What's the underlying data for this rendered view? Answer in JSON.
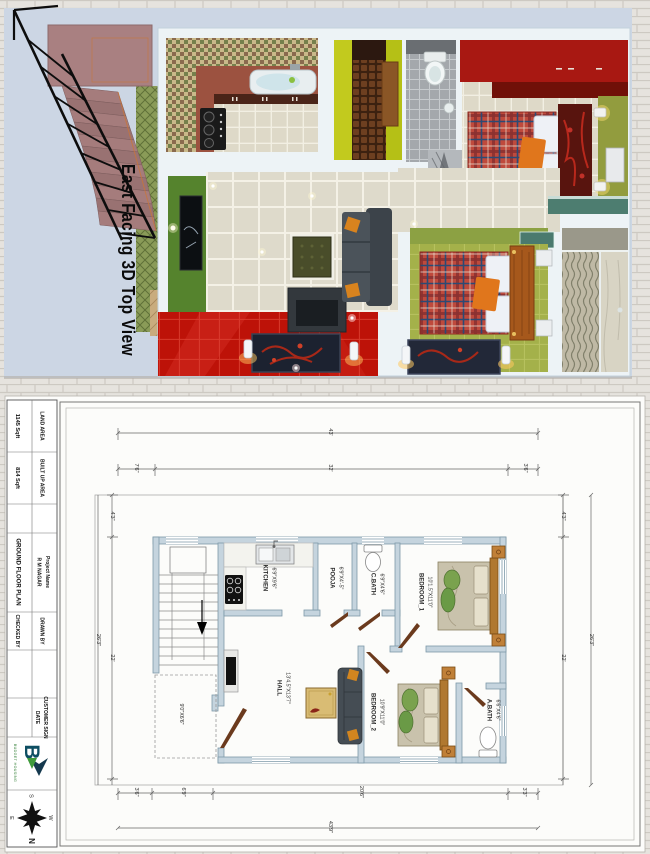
{
  "view3d": {
    "caption": "East Facing 3D Top View"
  },
  "title_block": {
    "land_area_label": "LAND AREA",
    "land_area_value": "1145 Sqft",
    "built_up_label": "BUILT UP AREA",
    "built_up_value": "814 Sqft",
    "project_label": "Project Name",
    "project_name": "R M NAGAR",
    "drawing_title": "GROUND FLOOR PLAN",
    "drawn_by_label": "DRAWN BY",
    "checked_by_label": "CHECKED BY",
    "customer_sign_label": "CUSTOMER SIGN",
    "date_label": "DATE",
    "logo_letter": "B",
    "logo_name": "BUDGET HOUSING",
    "compass": {
      "n": "N",
      "s": "S",
      "e": "E",
      "w": "W"
    }
  },
  "plan": {
    "rooms": {
      "kitchen": {
        "name": "KITCHEN",
        "size": "6'9\"X9'6\""
      },
      "pooja": {
        "name": "POOJA",
        "size": "6'9\"X4'-5\""
      },
      "cbath": {
        "name": "C.BATH",
        "size": "6'9\"X4'6\""
      },
      "bedroom1": {
        "name": "BEDROOM_1",
        "size": "10'1.5\"X11'0\""
      },
      "hall": {
        "name": "HALL",
        "size": "13'4.5\"X13'7\""
      },
      "bedroom2": {
        "name": "BEDROOM_2",
        "size": "10'9\"X11'0\""
      },
      "abath": {
        "name": "A.BATH",
        "size": "6'6\"X4'6\""
      },
      "sitout": {
        "size": "9'0\"X6'6\""
      }
    },
    "dims": {
      "top_total": "43'",
      "top_a": "7'6\"",
      "top_b": "32'",
      "top_c": "3'6\"",
      "left_a": "4'3\"",
      "left_b": "22'",
      "left_total": "26'3\"",
      "right_a": "4'3\"",
      "right_b": "22'",
      "right_total": "26'3\"",
      "bottom_a": "3'6\"",
      "bottom_b": "6'9\"",
      "bottom_c": "20'6\"",
      "bottom_d": "3'3\"",
      "bottom_total": "43'9\""
    }
  },
  "colors": {
    "panel_blue": "#ccd6e4",
    "wall_2d": "#c5d4de",
    "accent_red": "#bd1208",
    "logo_teal": "#0d4e62",
    "logo_green": "#2e7d32"
  }
}
